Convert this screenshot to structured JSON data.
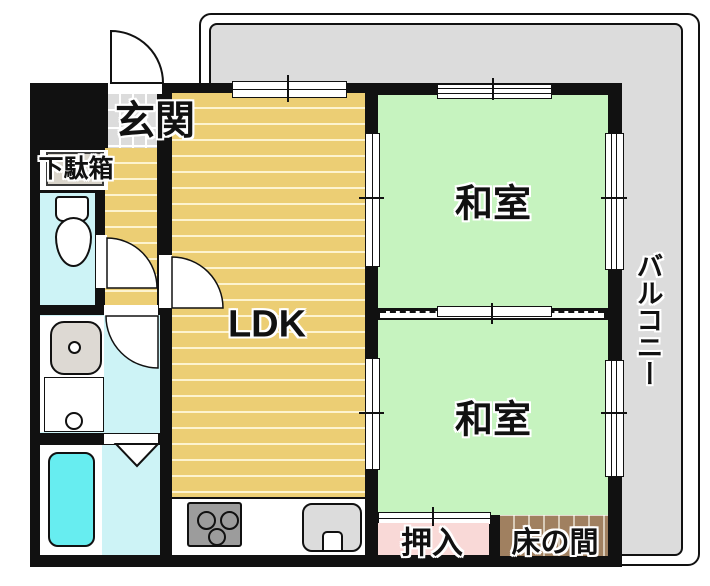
{
  "rooms": {
    "genkan": {
      "label": "玄関"
    },
    "getabako": {
      "label": "下駄箱"
    },
    "ldk": {
      "label": "LDK"
    },
    "washitsu_top": {
      "label": "和室"
    },
    "washitsu_bottom": {
      "label": "和室"
    },
    "oshiire": {
      "label": "押入"
    },
    "tokonoma": {
      "label": "床の間"
    },
    "balcony": {
      "label": "バルコニー"
    }
  },
  "colors": {
    "wall": "#111111",
    "wood": "#ecce74",
    "wood-stripe": "#fdf3cf",
    "tatami": "#c6f3bf",
    "balcony-floor": "#dcdcdc",
    "tile": "#dcdcdc",
    "water": "#cdf3f6",
    "bathtub": "#67edf0",
    "closet-pink": "#f9d9d7",
    "tokonoma-brown": "#a08060",
    "cabinet": "#d9d4ca",
    "appliance-gray": "#9c9c9c",
    "sink-gray": "#dcdcdc"
  }
}
